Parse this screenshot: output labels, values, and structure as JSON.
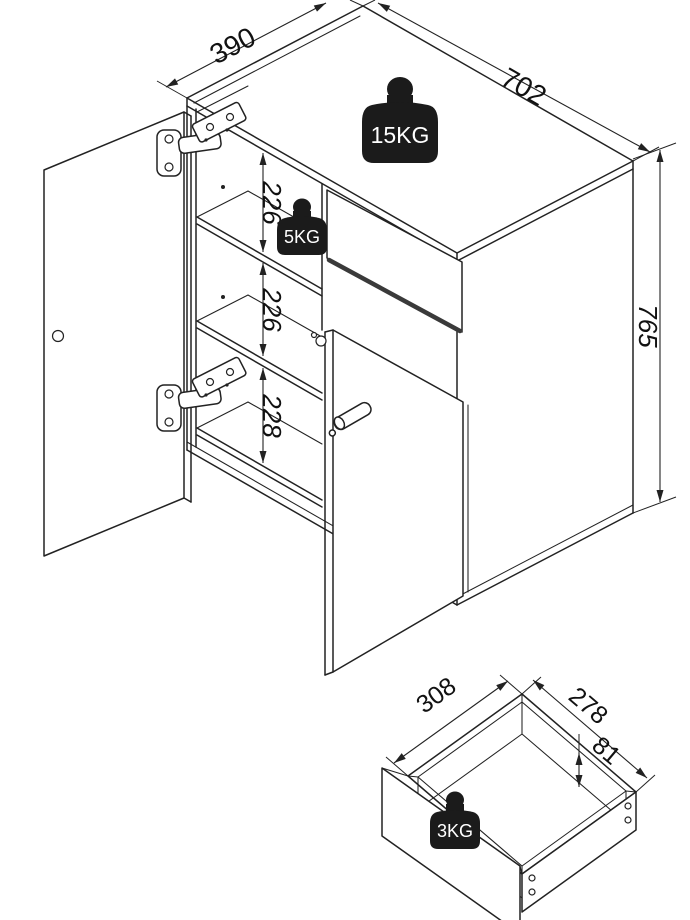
{
  "diagram": {
    "main_view": {
      "dim_depth": "390",
      "dim_width": "702",
      "dim_height": "765",
      "shelf_spacings": [
        "226",
        "226",
        "228"
      ],
      "top_load": "15KG",
      "shelf_load": "5KG"
    },
    "drawer_view": {
      "dim_width": "308",
      "dim_depth": "278",
      "dim_height": "81",
      "load": "3KG"
    }
  },
  "colors": {
    "line": "#222222",
    "weight_fill": "#1b1b1b",
    "weight_text": "#ffffff",
    "background": "#ffffff"
  }
}
